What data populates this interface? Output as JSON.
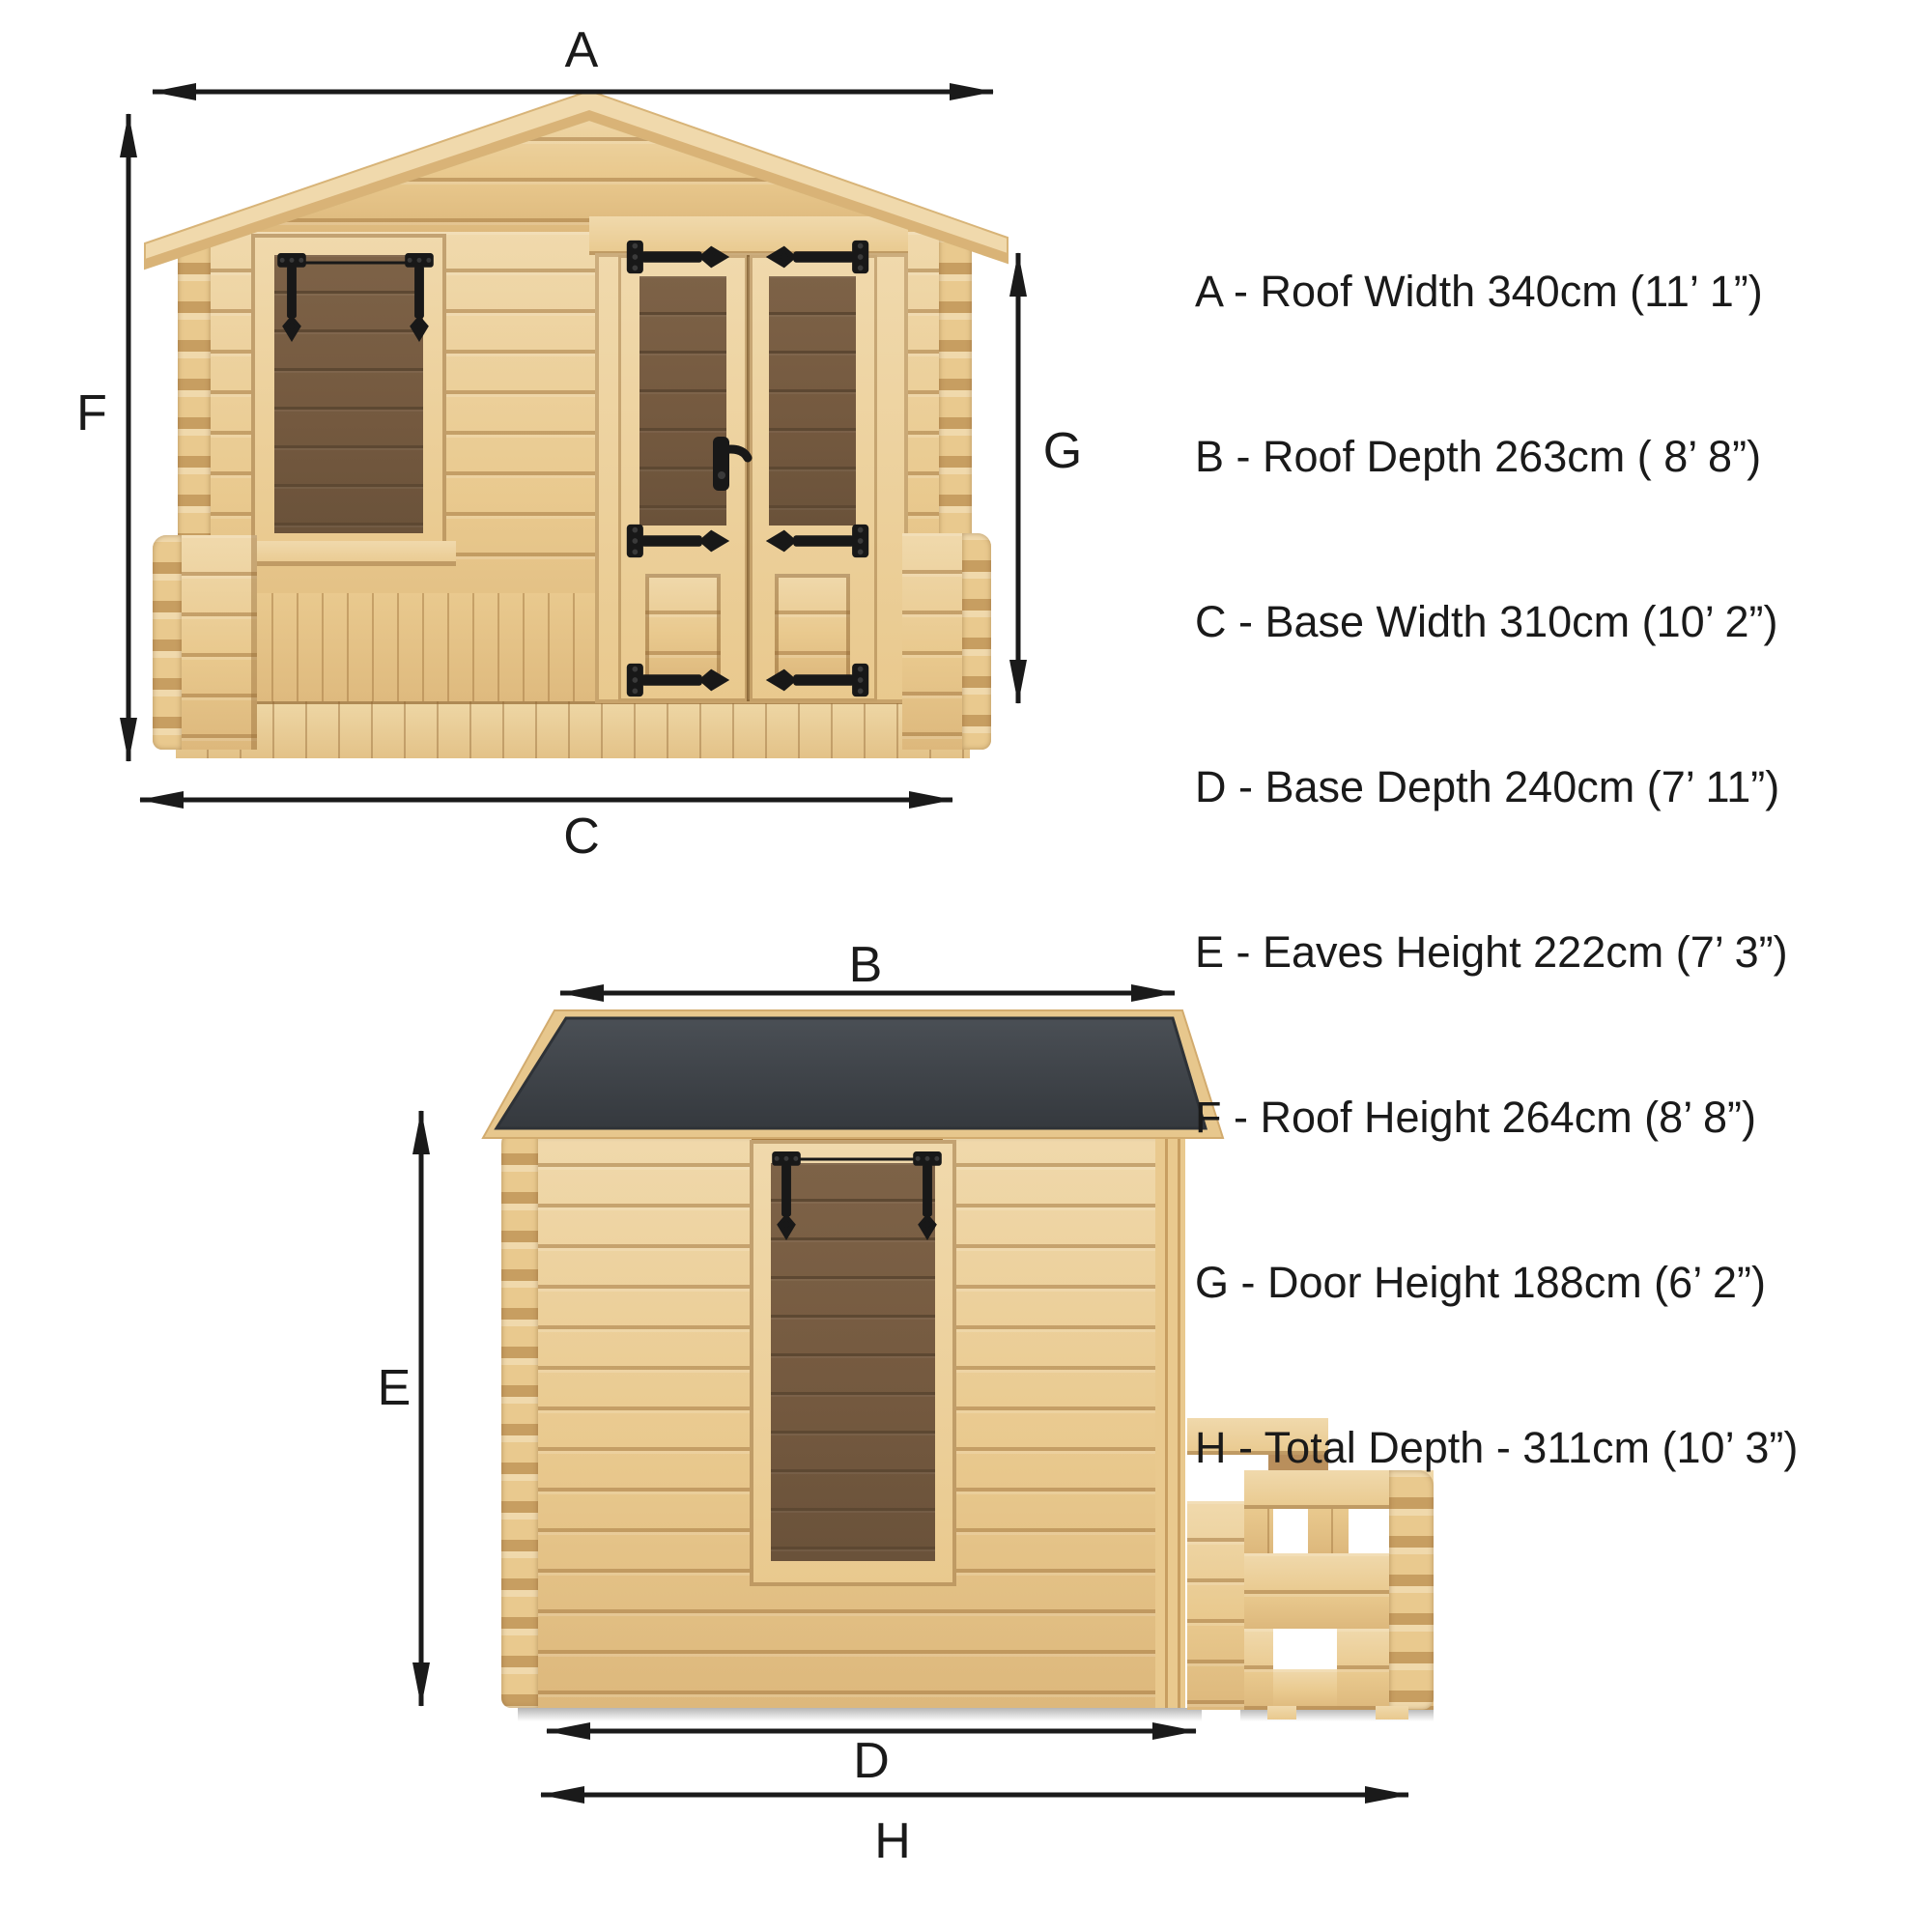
{
  "title": "Log cabin dimension diagram",
  "front_view": {
    "name": "Front elevation with dimension arrows",
    "dimension_labels": {
      "roof_width": "A",
      "roof_height": "F",
      "door_height": "G",
      "base_width": "C"
    }
  },
  "side_view": {
    "name": "Side elevation with dimension arrows",
    "dimension_labels": {
      "roof_depth": "B",
      "eaves_height": "E",
      "base_depth": "D",
      "total_depth": "H"
    }
  },
  "legend": {
    "items": [
      {
        "letter": "A",
        "label": "A - Roof Width 340cm (11’ 1”)"
      },
      {
        "letter": "B",
        "label": "B - Roof Depth 263cm ( 8’ 8”)"
      },
      {
        "letter": "C",
        "label": "C - Base Width 310cm (10’ 2”)"
      },
      {
        "letter": "D",
        "label": "D - Base Depth 240cm (7’ 11”)"
      },
      {
        "letter": "E",
        "label": "E - Eaves Height 222cm (7’ 3”)"
      },
      {
        "letter": "F",
        "label": "F - Roof Height 264cm (8’ 8”)"
      },
      {
        "letter": "G",
        "label": "G - Door Height 188cm (6’ 2”)"
      },
      {
        "letter": "H",
        "label": "H - Total Depth - 311cm (10’ 3”)"
      }
    ]
  },
  "colors": {
    "ink": "#1a1a1a",
    "wood": "#e9c98e",
    "wood_light": "#f0d9ac",
    "wood_dark": "#ddb87c",
    "wood_deep": "#c79e61",
    "deck": "#eed6a4",
    "glass": "#74593f",
    "glass_line": "#5d4832",
    "roof_dark": "#3f444a",
    "roof_edge": "#2e3237",
    "header_brown": "#a97c3f",
    "interior_brown": "#b98f5c",
    "shadow": "#bfbfbf"
  }
}
